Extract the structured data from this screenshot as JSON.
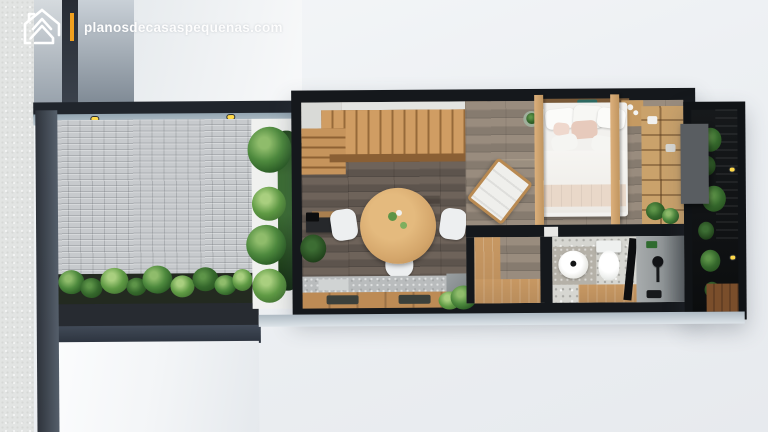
{
  "watermark": {
    "text": "planosdecasaspequenas.com",
    "text_color": "#FDFDFD",
    "separator_color": "#F0A01E",
    "icon": "house-outline-logo-icon"
  },
  "scene": {
    "type": "3d-floor-plan-top-down-render",
    "description_visible_content": "Narrow small-house plan: cobblestone front patio with planting beds, palm garden strip, living-dining room with L-shaped wood staircase, round dining table with three white chairs, TV console, wood deck edge, L-shaped wood counter, bedroom with four-poster double bed and lounge chair, wardrobe shelving, bathroom with round basin, toilet and dark glass shower, dark side garden with plants and rear deck",
    "background_color": "#EDF0F3",
    "colors": {
      "dark_wall": "#15181C",
      "wall_cap": "#39404D",
      "cobblestone": "#C7CACD",
      "living_floor": "#665C54",
      "bedroom_floor": "#8B8073",
      "stair_wood": "#C08A50",
      "counter_wood": "#D2A068",
      "table_wood": "#D9AC72",
      "deck_wood": "#BD8B55",
      "bedding": "#F2F1EE",
      "blush_pillow": "#E7CABC",
      "plant_green": "#4E8A3E",
      "terrazzo": "#D6D6D1",
      "accent_light": "#FFD94A"
    },
    "areas": [
      "front-patio",
      "planting-strip",
      "palm-garden-strip",
      "living-dining-room",
      "staircase",
      "tv-console",
      "dining-set",
      "entry-deck",
      "kitchen-counter",
      "bedroom",
      "four-poster-bed",
      "lounge-chair",
      "wardrobe",
      "bathroom",
      "shower",
      "side-garden",
      "front-wall"
    ]
  }
}
